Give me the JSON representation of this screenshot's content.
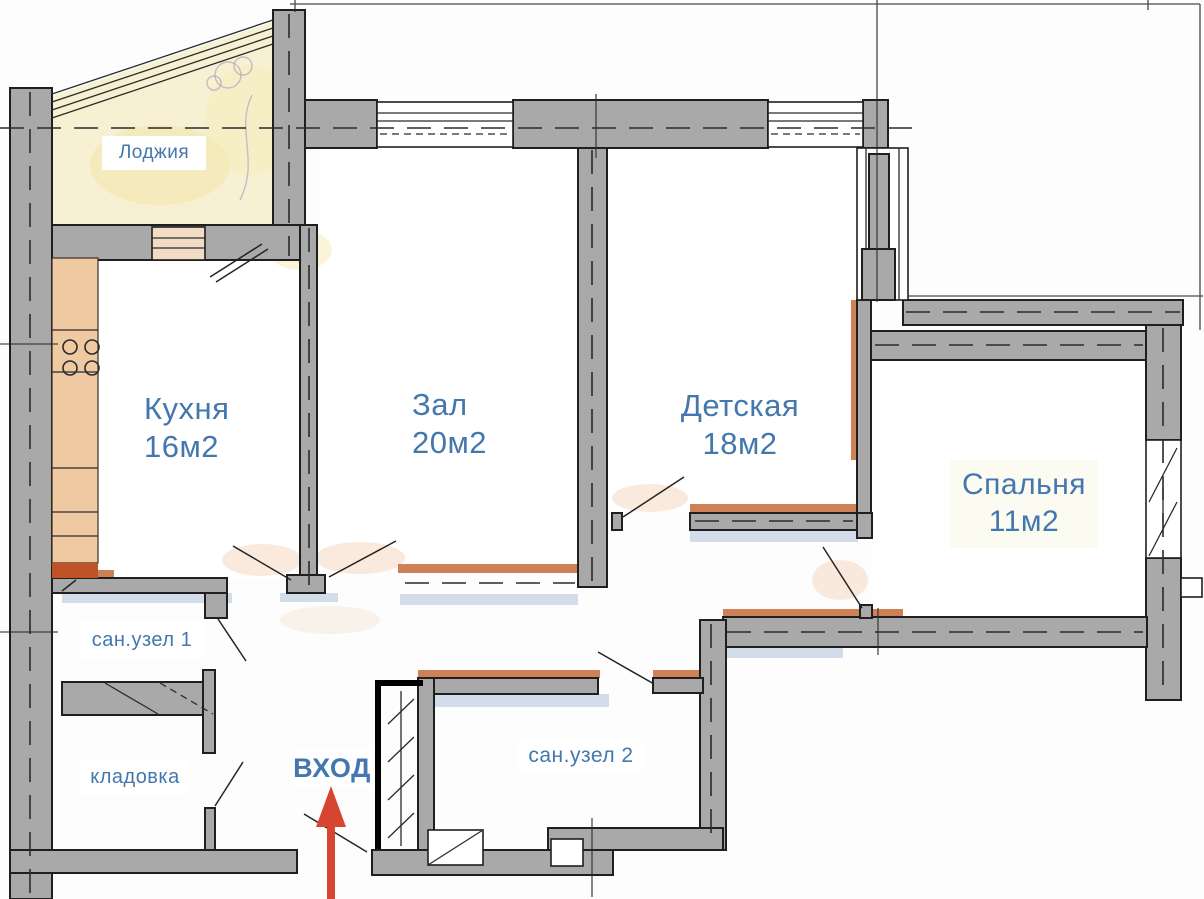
{
  "plan": {
    "type": "apartment floor plan",
    "rooms": {
      "loggia": {
        "label": "Лоджия"
      },
      "kitchen": {
        "label": "Кухня",
        "area": "16м2"
      },
      "living": {
        "label": "Зал",
        "area": "20м2"
      },
      "children": {
        "label": "Детская",
        "area": "18м2"
      },
      "bedroom": {
        "label": "Спальня",
        "area": "11м2"
      },
      "bathroom1": {
        "label": "сан.узел 1"
      },
      "bathroom2": {
        "label": "сан.узел 2"
      },
      "storage": {
        "label": "кладовка"
      }
    },
    "entrance": {
      "label": "ВХОД"
    }
  },
  "colors": {
    "paper": "#fdfdfd",
    "wall_fill": "#a9a9a9",
    "outline": "#1f1f1f",
    "label_blue": "#4377ad",
    "arrow_red": "#d64530",
    "counter_tan": "#eec9a2",
    "accent_orange": "#c2602c",
    "loggia_yellow": "#f7f0d2",
    "wash_blue": "#a9bdd6"
  }
}
